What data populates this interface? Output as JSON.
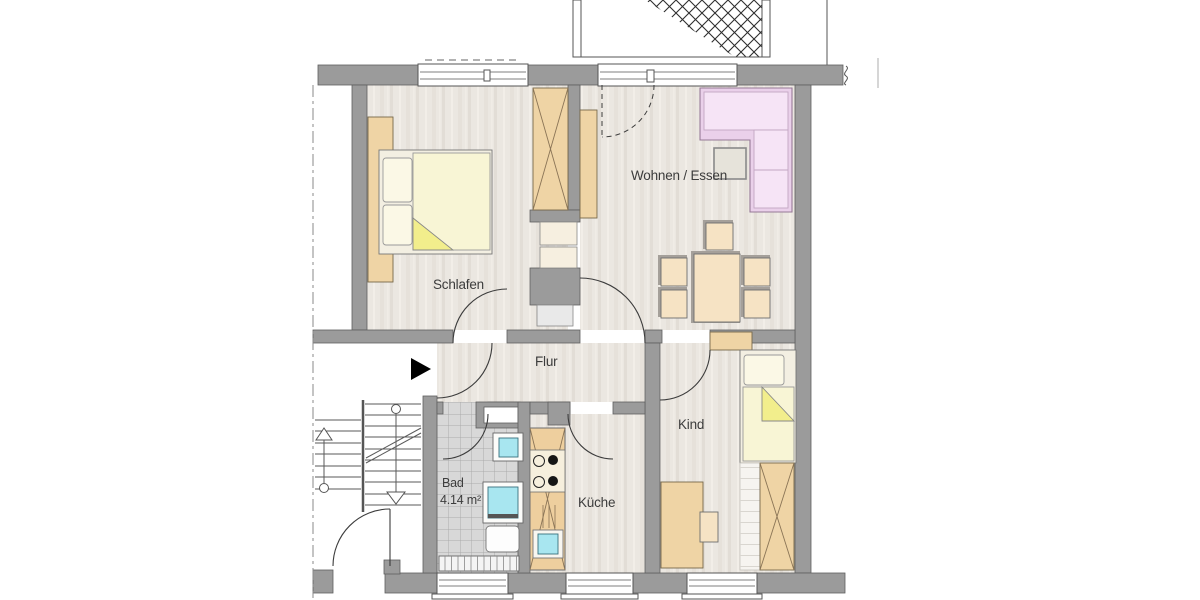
{
  "plan": {
    "rooms": {
      "schlafen": "Schlafen",
      "wohnen_essen": "Wohnen / Essen",
      "flur": "Flur",
      "kind": "Kind",
      "bad": "Bad",
      "bad_area": "4.14 m²",
      "kueche": "Küche"
    },
    "icons": {
      "entrance_arrow": "▶"
    },
    "colors": {
      "wall": "#9b9b9b",
      "wood_floor": "#ebe7e1",
      "tile_floor": "#d8d8d8",
      "furniture_wood": "#efd4a5",
      "bed_linen": "#f8f5d5",
      "fold_highlight": "#f2ee8c",
      "sofa_pink": "#ead0ea",
      "water_cyan": "#a8e6f0",
      "label_text": "#3c3c3c"
    }
  }
}
